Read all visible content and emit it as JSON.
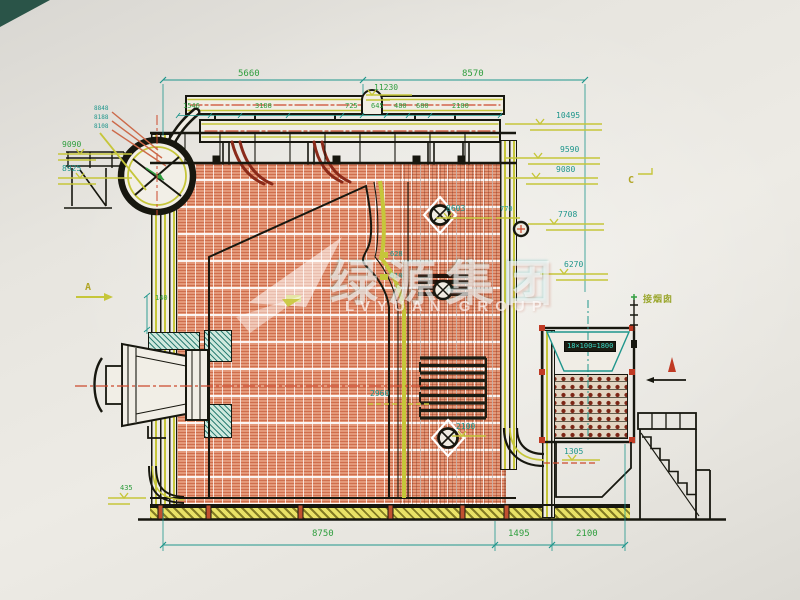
{
  "drawing": {
    "kind": "boiler-side-elevation",
    "watermark": {
      "cn": "绿源集团",
      "en": "LVYUAN GROUP"
    }
  },
  "palette": {
    "paper": "#e9e6e0",
    "line_black": "#17170f",
    "dim_teal": "#1f968c",
    "dim_green": "#2f9e3e",
    "accent_yellow": "#c6c63a",
    "centerline_red": "#cc4a2e",
    "furnace_orange": "#e4997a",
    "hatch_teal": "#1f7a6e",
    "corner_teal": "#2a5448"
  },
  "annotations": [
    {
      "name": "dim-5660",
      "text": "5660",
      "x": 238,
      "y": 70,
      "cls": "g8"
    },
    {
      "name": "dim-8570",
      "text": "8570",
      "x": 462,
      "y": 70,
      "cls": "g8"
    },
    {
      "name": "level-11230",
      "text": "11230",
      "x": 374,
      "y": 84,
      "cls": "g7"
    },
    {
      "name": "dim-1546",
      "text": "1546",
      "x": 183,
      "y": 103,
      "cls": "g6"
    },
    {
      "name": "dim-3188",
      "text": "3188",
      "x": 255,
      "y": 103,
      "cls": "g6"
    },
    {
      "name": "dim-725",
      "text": "725",
      "x": 345,
      "y": 103,
      "cls": "g6"
    },
    {
      "name": "dim-645",
      "text": "645",
      "x": 371,
      "y": 103,
      "cls": "g6"
    },
    {
      "name": "dim-480",
      "text": "480",
      "x": 394,
      "y": 103,
      "cls": "g6"
    },
    {
      "name": "dim-680",
      "text": "680",
      "x": 416,
      "y": 103,
      "cls": "g6"
    },
    {
      "name": "dim-2180",
      "text": "2180",
      "x": 452,
      "y": 103,
      "cls": "g6"
    },
    {
      "name": "level-10495",
      "text": "10495",
      "x": 556,
      "y": 112,
      "cls": "t7"
    },
    {
      "name": "level-9590",
      "text": "9590",
      "x": 560,
      "y": 146,
      "cls": "t7"
    },
    {
      "name": "level-9080",
      "text": "9080",
      "x": 556,
      "y": 166,
      "cls": "t7"
    },
    {
      "name": "section-c",
      "text": "C",
      "x": 628,
      "y": 176,
      "cls": "y9"
    },
    {
      "name": "level-7708",
      "text": "7708",
      "x": 558,
      "y": 211,
      "cls": "t7"
    },
    {
      "name": "level-6270",
      "text": "6270",
      "x": 564,
      "y": 261,
      "cls": "t7"
    },
    {
      "name": "level-8848",
      "text": "8848",
      "x": 94,
      "y": 106,
      "cls": "t5"
    },
    {
      "name": "level-8188",
      "text": "8188",
      "x": 94,
      "y": 115,
      "cls": "t5"
    },
    {
      "name": "level-8108",
      "text": "8108",
      "x": 94,
      "y": 124,
      "cls": "t5"
    },
    {
      "name": "level-9090",
      "text": "9090",
      "x": 62,
      "y": 141,
      "cls": "g7"
    },
    {
      "name": "level-8925",
      "text": "8925",
      "x": 62,
      "y": 165,
      "cls": "t7"
    },
    {
      "name": "section-a",
      "text": "A",
      "x": 85,
      "y": 283,
      "cls": "y9"
    },
    {
      "name": "dim-140",
      "text": "140",
      "x": 155,
      "y": 295,
      "cls": "g6"
    },
    {
      "name": "level-8603",
      "text": "8603",
      "x": 446,
      "y": 205,
      "cls": "t7"
    },
    {
      "name": "dim-770",
      "text": "770",
      "x": 500,
      "y": 206,
      "cls": "t6"
    },
    {
      "name": "dim-628",
      "text": "628",
      "x": 390,
      "y": 251,
      "cls": "t6"
    },
    {
      "name": "dim-610",
      "text": "610",
      "x": 390,
      "y": 273,
      "cls": "t6"
    },
    {
      "name": "dim-2960",
      "text": "2960",
      "x": 370,
      "y": 390,
      "cls": "t7"
    },
    {
      "name": "dim-2100-mid",
      "text": "2100",
      "x": 456,
      "y": 423,
      "cls": "t7"
    },
    {
      "name": "airheater-tube-count",
      "text": "18×100=1800",
      "x": 564,
      "y": 341,
      "cls": "tband"
    },
    {
      "name": "flue-outlet-note",
      "text": "接烟囱",
      "x": 643,
      "y": 296,
      "cls": "gcjk"
    },
    {
      "name": "level-1305",
      "text": "1305",
      "x": 564,
      "y": 448,
      "cls": "t7"
    },
    {
      "name": "level-435",
      "text": "435",
      "x": 120,
      "y": 485,
      "cls": "g6"
    },
    {
      "name": "dim-8750",
      "text": "8750",
      "x": 312,
      "y": 530,
      "cls": "g8"
    },
    {
      "name": "dim-1495",
      "text": "1495",
      "x": 508,
      "y": 530,
      "cls": "g8"
    },
    {
      "name": "dim-2100-right",
      "text": "2100",
      "x": 576,
      "y": 530,
      "cls": "g8"
    }
  ]
}
